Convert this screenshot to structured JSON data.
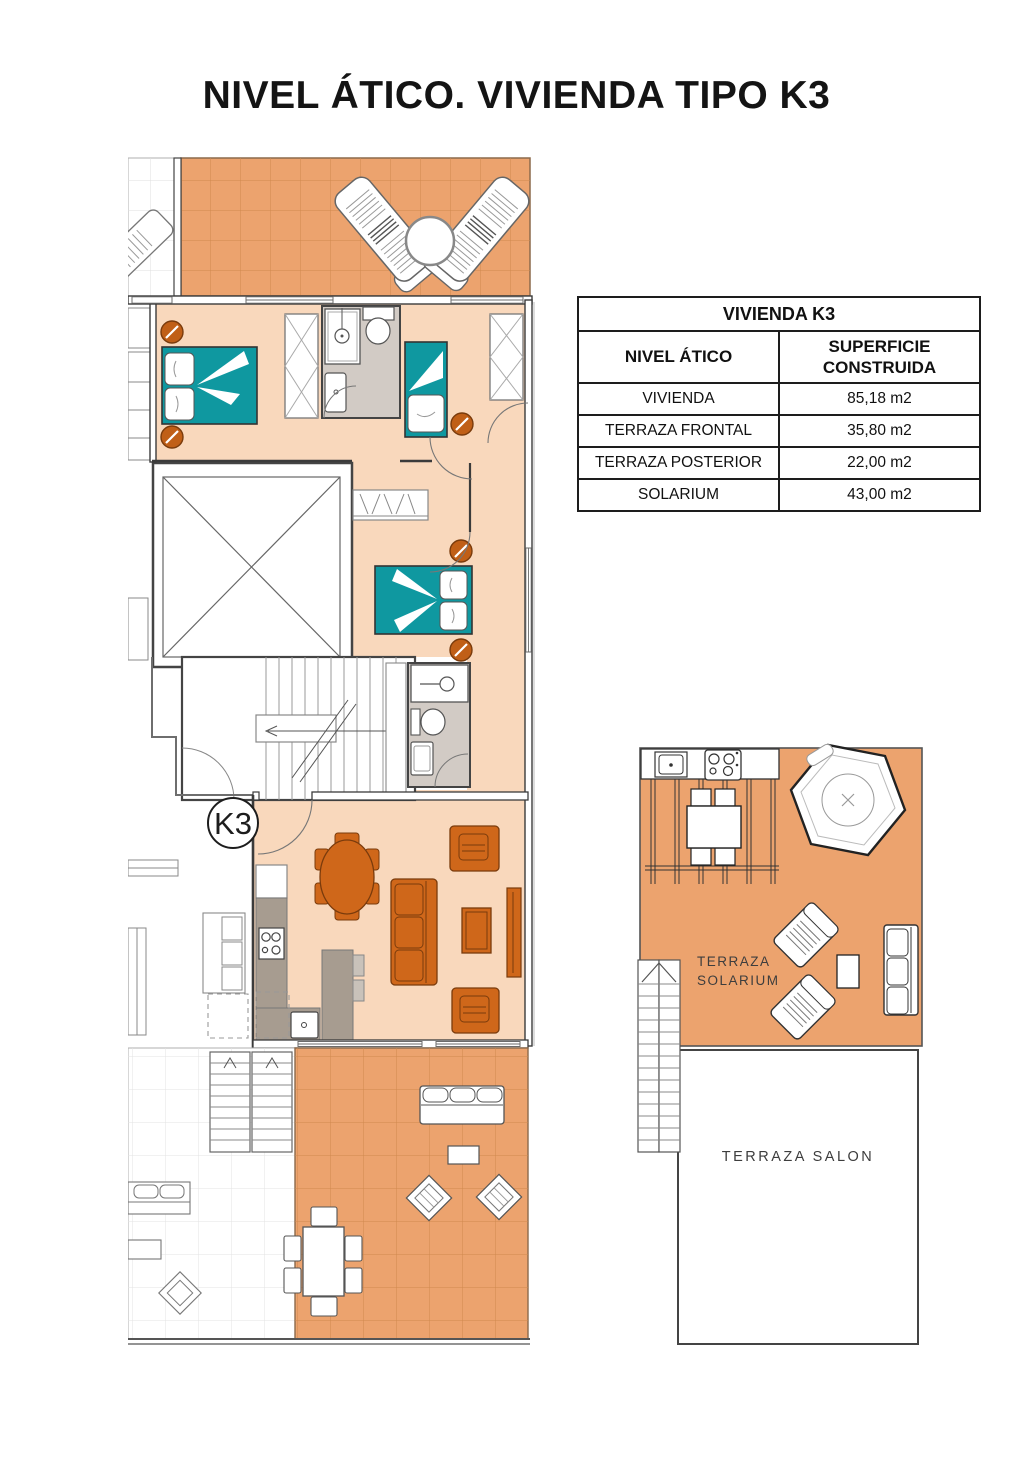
{
  "title": "NIVEL ÁTICO. VIVIENDA TIPO K3",
  "floor_plan": {
    "unit_badge": "K3"
  },
  "area_table": {
    "title": "VIVIENDA K3",
    "col_level": "NIVEL ÁTICO",
    "col_surface": "SUPERFICIE CONSTRUIDA",
    "rows": [
      {
        "name": "VIVIENDA",
        "value": "85,18 m2"
      },
      {
        "name": "TERRAZA FRONTAL",
        "value": "35,80 m2"
      },
      {
        "name": "TERRAZA POSTERIOR",
        "value": "22,00 m2"
      },
      {
        "name": "SOLARIUM",
        "value": "43,00 m2"
      }
    ]
  },
  "solarium_plan": {
    "label_line1": "TERRAZA",
    "label_line2": "SOLARIUM",
    "salon_label": "TERRAZA SALON"
  },
  "colors": {
    "terrace_tile": "#ECA36E",
    "terrace_tile_line": "#D0884E",
    "interior_floor": "#F9D8BC",
    "bed_teal": "#0F98A0",
    "furniture_orange": "#CF671A",
    "nightstand_orange": "#C05F17",
    "bathroom_floor": "#D2CBC5",
    "kitchen_counter": "#A79C90",
    "wall": "#3B3B3B"
  }
}
